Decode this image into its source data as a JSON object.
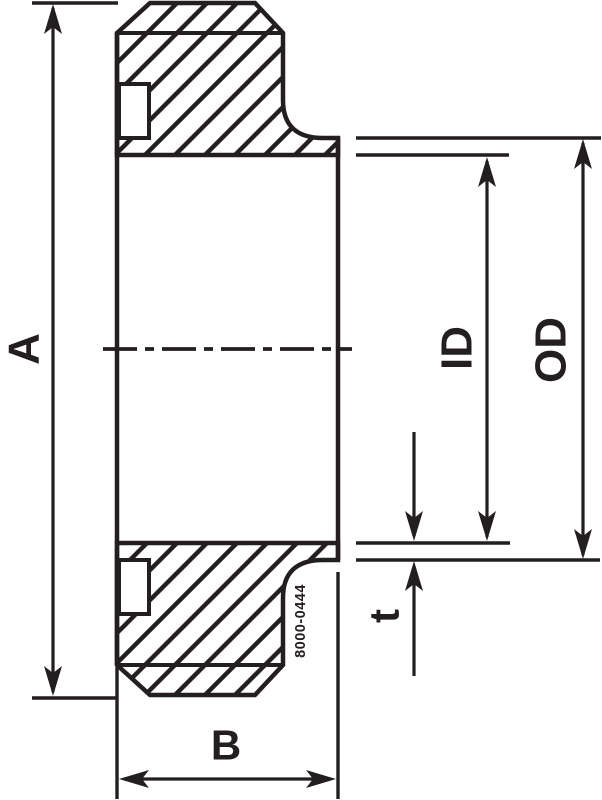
{
  "drawing": {
    "labels": {
      "length_a": "A",
      "length_b": "B",
      "inner_diameter": "ID",
      "outer_diameter": "OD",
      "wall_thickness": "t",
      "drawing_number": "8000-0444"
    },
    "colors": {
      "line": "#231f20",
      "background": "#ffffff"
    }
  }
}
